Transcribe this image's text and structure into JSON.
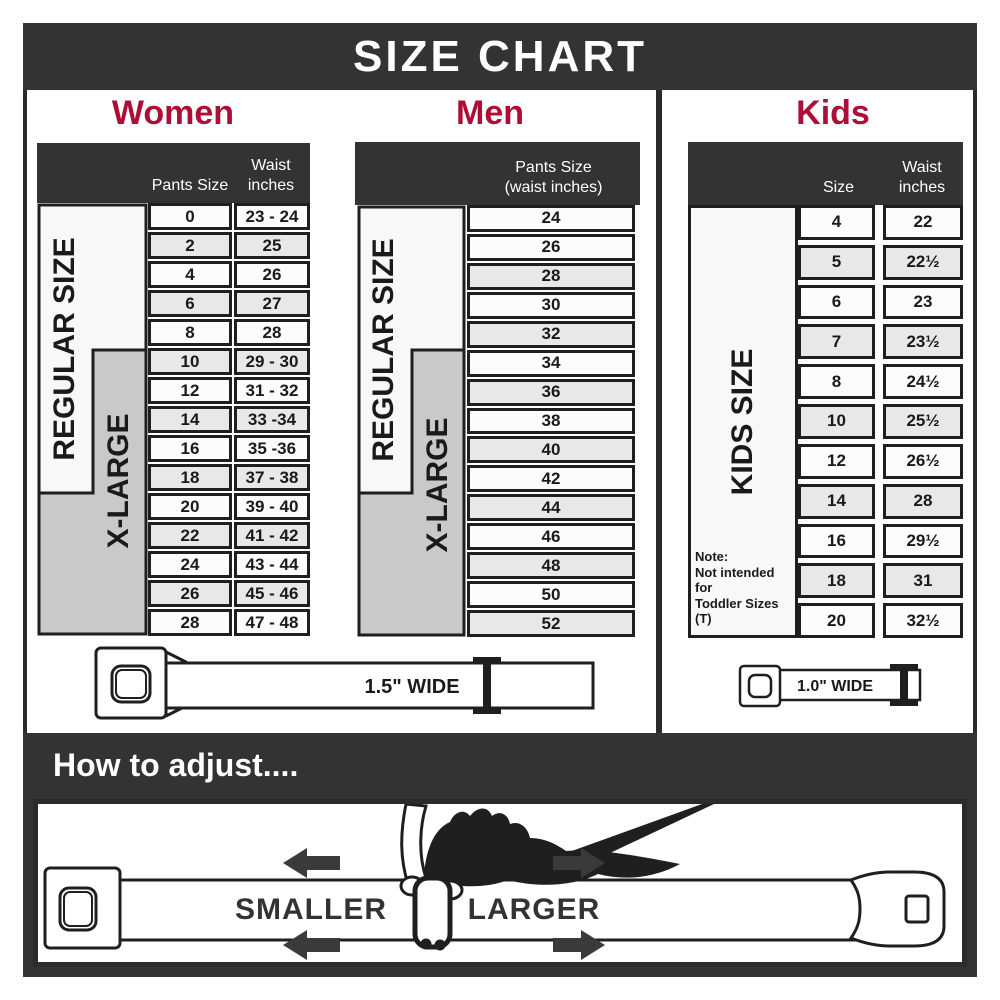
{
  "title": "SIZE CHART",
  "colors": {
    "dark": "#333333",
    "accent_red": "#AE0E36",
    "row_gray": "#E8E8E8",
    "row_white": "#FCFCFC",
    "xlarge_gray": "#C9C9C9"
  },
  "women": {
    "title": "Women",
    "regular_label": "REGULAR SIZE",
    "xlarge_label": "X-LARGE",
    "col_pants": "Pants Size",
    "col_waist": "Waist\ninches",
    "rows": [
      {
        "size": "0",
        "waist": "23 - 24"
      },
      {
        "size": "2",
        "waist": "25"
      },
      {
        "size": "4",
        "waist": "26"
      },
      {
        "size": "6",
        "waist": "27"
      },
      {
        "size": "8",
        "waist": "28"
      },
      {
        "size": "10",
        "waist": "29 - 30"
      },
      {
        "size": "12",
        "waist": "31 - 32"
      },
      {
        "size": "14",
        "waist": "33 -34"
      },
      {
        "size": "16",
        "waist": "35 -36"
      },
      {
        "size": "18",
        "waist": "37 - 38"
      },
      {
        "size": "20",
        "waist": "39 - 40"
      },
      {
        "size": "22",
        "waist": "41 - 42"
      },
      {
        "size": "24",
        "waist": "43 - 44"
      },
      {
        "size": "26",
        "waist": "45 - 46"
      },
      {
        "size": "28",
        "waist": "47 - 48"
      }
    ]
  },
  "men": {
    "title": "Men",
    "regular_label": "REGULAR SIZE",
    "xlarge_label": "X-LARGE",
    "col_header": "Pants Size\n(waist inches)",
    "rows": [
      "24",
      "26",
      "28",
      "30",
      "32",
      "34",
      "36",
      "38",
      "40",
      "42",
      "44",
      "46",
      "48",
      "50",
      "52"
    ]
  },
  "kids": {
    "title": "Kids",
    "size_label": "KIDS SIZE",
    "col_size": "Size",
    "col_waist": "Waist\ninches",
    "note": "Note:\nNot intended for\nToddler Sizes (T)",
    "rows": [
      {
        "size": "4",
        "waist": "22"
      },
      {
        "size": "5",
        "waist": "22½"
      },
      {
        "size": "6",
        "waist": "23"
      },
      {
        "size": "7",
        "waist": "23½"
      },
      {
        "size": "8",
        "waist": "24½"
      },
      {
        "size": "10",
        "waist": "25½"
      },
      {
        "size": "12",
        "waist": "26½"
      },
      {
        "size": "14",
        "waist": "28"
      },
      {
        "size": "16",
        "waist": "29½"
      },
      {
        "size": "18",
        "waist": "31"
      },
      {
        "size": "20",
        "waist": "32½"
      }
    ]
  },
  "belts": {
    "women_men_width": "1.5\" WIDE",
    "kids_width": "1.0\" WIDE"
  },
  "how_to": {
    "heading": "How to adjust....",
    "smaller": "SMALLER",
    "larger": "LARGER"
  }
}
